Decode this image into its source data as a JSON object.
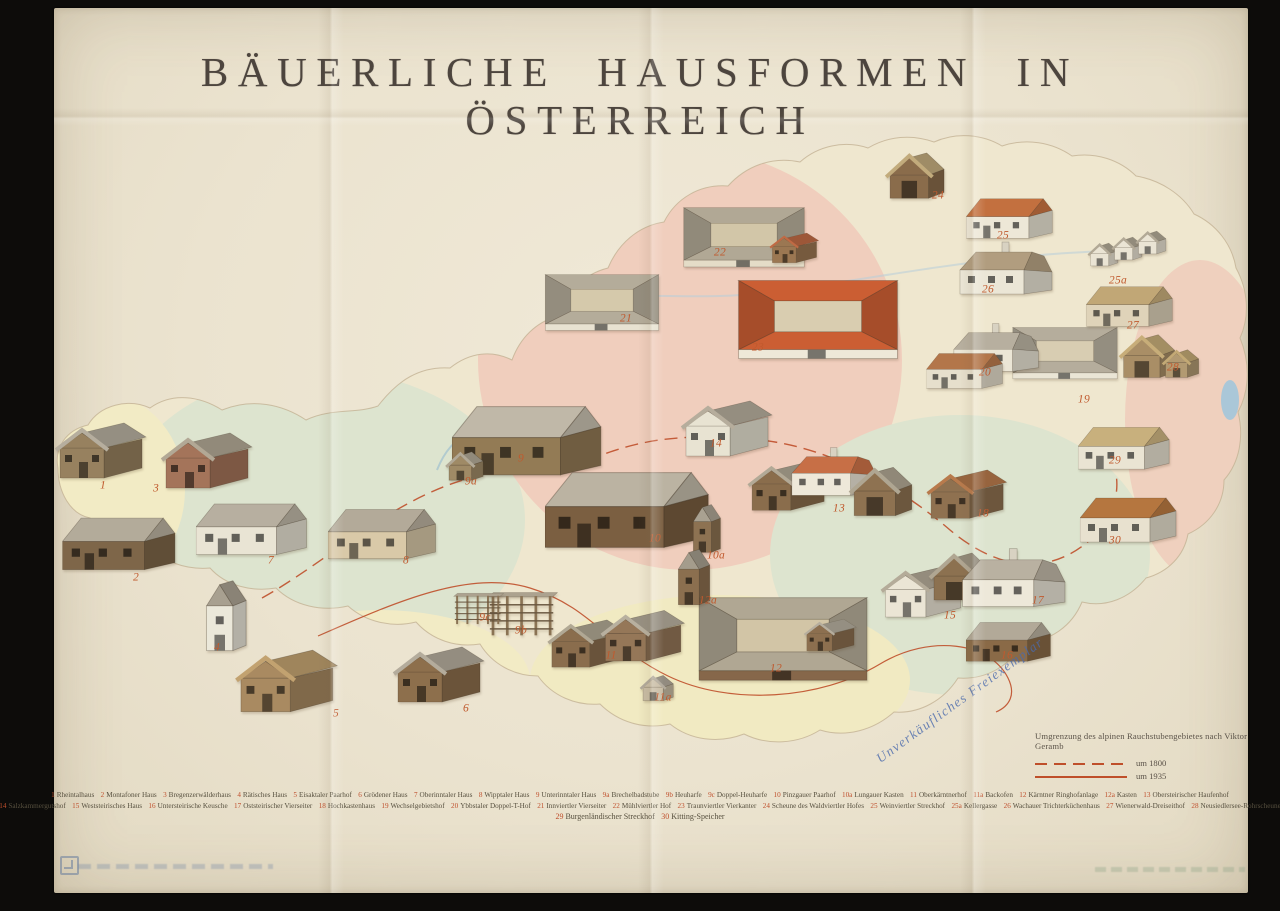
{
  "poster": {
    "title": "BÄUERLICHE HAUSFORMEN IN ÖSTERREICH",
    "stamp": "Unverkäufliches Freiexemplar",
    "colors": {
      "paper": "#ebe3cf",
      "accent_red": "#bf4f2a",
      "ink": "#57503f",
      "number_red": "#c05a2e",
      "stamp_blue": "#4a6aad",
      "map_pink": "#f0cebd",
      "map_green": "#dde4cf",
      "map_yellow": "#f1eac4",
      "lake_blue": "#a9c6d6"
    },
    "map_legend": {
      "heading": "Umgrenzung des alpinen Rauchstubengebietes nach Viktor Geramb",
      "entries": [
        {
          "style": "dashed",
          "label": "um 1800"
        },
        {
          "style": "solid",
          "label": "um 1935"
        }
      ]
    },
    "legend_lines": [
      [
        {
          "n": "1",
          "name": "Rheintalhaus"
        },
        {
          "n": "2",
          "name": "Montafoner Haus"
        },
        {
          "n": "3",
          "name": "Bregenzerwälderhaus"
        },
        {
          "n": "4",
          "name": "Rätisches Haus"
        },
        {
          "n": "5",
          "name": "Eisaktaler Paarhof"
        },
        {
          "n": "6",
          "name": "Grödener Haus"
        },
        {
          "n": "7",
          "name": "Oberinntaler Haus"
        },
        {
          "n": "8",
          "name": "Wipptaler Haus"
        },
        {
          "n": "9",
          "name": "Unterinntaler Haus"
        },
        {
          "n": "9a",
          "name": "Brechelbadstube"
        },
        {
          "n": "9b",
          "name": "Heuharfe"
        },
        {
          "n": "9c",
          "name": "Doppel-Heuharfe"
        },
        {
          "n": "10",
          "name": "Pinzgauer Paarhof"
        },
        {
          "n": "10a",
          "name": "Lungauer Kasten"
        },
        {
          "n": "11",
          "name": "Oberkärntnerhof"
        },
        {
          "n": "11a",
          "name": "Backofen"
        },
        {
          "n": "12",
          "name": "Kärntner Ringhofanlage"
        },
        {
          "n": "12a",
          "name": "Kasten"
        },
        {
          "n": "13",
          "name": "Obersteirischer Haufenhof"
        }
      ],
      [
        {
          "n": "14",
          "name": "Salzkammergutshof"
        },
        {
          "n": "15",
          "name": "Weststeirisches Haus"
        },
        {
          "n": "16",
          "name": "Untersteirische Keusche"
        },
        {
          "n": "17",
          "name": "Oststeirischer Vierseiter"
        },
        {
          "n": "18",
          "name": "Hochkastenhaus"
        },
        {
          "n": "19",
          "name": "Wechselgebietshof"
        },
        {
          "n": "20",
          "name": "Ybbstaler Doppel-T-Hof"
        },
        {
          "n": "21",
          "name": "Innviertler Vierseiter"
        },
        {
          "n": "22",
          "name": "Mühlviertler Hof"
        },
        {
          "n": "23",
          "name": "Traunviertler Vierkanter"
        },
        {
          "n": "24",
          "name": "Scheune des Waldviertler Hofes"
        },
        {
          "n": "25",
          "name": "Weinviertler Streckhof"
        },
        {
          "n": "25a",
          "name": "Kellergasse"
        },
        {
          "n": "26",
          "name": "Wachauer Trichterküchenhaus"
        },
        {
          "n": "27",
          "name": "Wienerwald-Dreiseithof"
        },
        {
          "n": "28",
          "name": "Neusiedlersee-Rohrscheune"
        }
      ],
      [
        {
          "n": "29",
          "name": "Burgenländischer Streckhof"
        },
        {
          "n": "30",
          "name": "Kitting-Speicher"
        }
      ]
    ],
    "houses": [
      {
        "n": "1",
        "lx": 103,
        "ly": 486,
        "parts": [
          {
            "t": "gable",
            "x": 52,
            "y": 414,
            "w": 100,
            "roof": "#b6ae9e",
            "wall": "#97815f"
          }
        ]
      },
      {
        "n": "2",
        "lx": 136,
        "ly": 578,
        "parts": [
          {
            "t": "long",
            "x": 62,
            "y": 504,
            "w": 118,
            "roof": "#b3ab9a",
            "wall": "#7e6649"
          }
        ]
      },
      {
        "n": "3",
        "lx": 156,
        "ly": 489,
        "parts": [
          {
            "t": "gable",
            "x": 158,
            "y": 424,
            "w": 100,
            "roof": "#b2a895",
            "wall": "#a4745a"
          }
        ]
      },
      {
        "n": "4",
        "lx": 217,
        "ly": 648,
        "parts": [
          {
            "t": "tower",
            "x": 196,
            "y": 574,
            "w": 58,
            "roof": "#a8a090",
            "wall": "#ebe8da"
          }
        ]
      },
      {
        "n": "5",
        "lx": 336,
        "ly": 714,
        "parts": [
          {
            "t": "gable",
            "x": 232,
            "y": 640,
            "w": 112,
            "roof": "#c2a270",
            "wall": "#a98a61"
          }
        ]
      },
      {
        "n": "6",
        "lx": 466,
        "ly": 709,
        "parts": [
          {
            "t": "gable",
            "x": 390,
            "y": 638,
            "w": 100,
            "roof": "#b4ac9c",
            "wall": "#8d6f4c"
          }
        ]
      },
      {
        "n": "7",
        "lx": 271,
        "ly": 561,
        "parts": [
          {
            "t": "long",
            "x": 196,
            "y": 490,
            "w": 115,
            "roof": "#b7afa0",
            "wall": "#e9e4d4"
          }
        ]
      },
      {
        "n": "8",
        "lx": 406,
        "ly": 561,
        "parts": [
          {
            "t": "long",
            "x": 328,
            "y": 496,
            "w": 112,
            "roof": "#b3aa99",
            "wall": "#d9c9a8"
          }
        ]
      },
      {
        "n": "9",
        "lx": 521,
        "ly": 459,
        "parts": [
          {
            "t": "long",
            "x": 452,
            "y": 388,
            "w": 155,
            "roof": "#c0b8a8",
            "wall": "#937b55"
          }
        ]
      },
      {
        "n": "9a",
        "lx": 471,
        "ly": 482,
        "parts": [
          {
            "t": "hut",
            "x": 443,
            "y": 448,
            "w": 48,
            "roof": "#b1a896",
            "wall": "#9f8a66"
          }
        ]
      },
      {
        "n": "9b",
        "lx": 521,
        "ly": 631,
        "parts": [
          {
            "t": "rack",
            "x": 486,
            "y": 588,
            "w": 72,
            "roof": "#aca28f",
            "wall": "#8a7354"
          }
        ]
      },
      {
        "n": "9c",
        "lx": 485,
        "ly": 618,
        "parts": [
          {
            "t": "rack",
            "x": 452,
            "y": 590,
            "w": 52,
            "roof": "#aca28f",
            "wall": "#8a7354"
          }
        ]
      },
      {
        "n": "10",
        "lx": 655,
        "ly": 539,
        "parts": [
          {
            "t": "long",
            "x": 545,
            "y": 452,
            "w": 170,
            "roof": "#bbb3a2",
            "wall": "#7b5f41"
          }
        ]
      },
      {
        "n": "10a",
        "lx": 716,
        "ly": 556,
        "parts": [
          {
            "t": "tower",
            "x": 686,
            "y": 500,
            "w": 40,
            "roof": "#a9a191",
            "wall": "#8d7252"
          }
        ]
      },
      {
        "n": "11",
        "lx": 611,
        "ly": 656,
        "parts": [
          {
            "t": "gable",
            "x": 545,
            "y": 612,
            "w": 86,
            "roof": "#b1a894",
            "wall": "#8a6d4d"
          },
          {
            "t": "gable",
            "x": 598,
            "y": 602,
            "w": 92,
            "roof": "#b8b09f",
            "wall": "#957758"
          }
        ]
      },
      {
        "n": "11a",
        "lx": 663,
        "ly": 698,
        "parts": [
          {
            "t": "hut",
            "x": 638,
            "y": 672,
            "w": 42,
            "roof": "#b2aa9b",
            "wall": "#c9bda5"
          }
        ]
      },
      {
        "n": "12",
        "lx": 776,
        "ly": 669,
        "parts": [
          {
            "t": "court",
            "x": 688,
            "y": 576,
            "w": 190,
            "roof": "#b0a793",
            "wall": "#86674a",
            "yard": "#d2c5a6"
          },
          {
            "t": "gable",
            "x": 802,
            "y": 614,
            "w": 58,
            "roof": "#b6ae9e",
            "wall": "#8c6f4f"
          }
        ]
      },
      {
        "n": "12a",
        "lx": 708,
        "ly": 601,
        "parts": [
          {
            "t": "tower",
            "x": 670,
            "y": 544,
            "w": 46,
            "roof": "#a49c8c",
            "wall": "#8b6f4f"
          }
        ]
      },
      {
        "n": "13",
        "lx": 839,
        "ly": 509,
        "parts": [
          {
            "t": "gable",
            "x": 745,
            "y": 454,
            "w": 88,
            "roof": "#b2a996",
            "wall": "#8a6d4c"
          },
          {
            "t": "hip",
            "x": 790,
            "y": 442,
            "w": 92,
            "roof": "#c76f46",
            "wall": "#eee8d9"
          },
          {
            "t": "barn",
            "x": 848,
            "y": 464,
            "w": 72,
            "roof": "#afa692",
            "wall": "#8e7251"
          }
        ]
      },
      {
        "n": "14",
        "lx": 716,
        "ly": 444,
        "parts": [
          {
            "t": "gable",
            "x": 678,
            "y": 392,
            "w": 100,
            "roof": "#b6ad9c",
            "wall": "#e8e3d2"
          }
        ]
      },
      {
        "n": "15",
        "lx": 950,
        "ly": 616,
        "parts": [
          {
            "t": "gable",
            "x": 878,
            "y": 558,
            "w": 92,
            "roof": "#b4ab99",
            "wall": "#ebe5d5"
          },
          {
            "t": "barn",
            "x": 928,
            "y": 550,
            "w": 70,
            "roof": "#b0a692",
            "wall": "#8c7150"
          }
        ]
      },
      {
        "n": "16",
        "lx": 1007,
        "ly": 656,
        "parts": [
          {
            "t": "long",
            "x": 966,
            "y": 612,
            "w": 88,
            "roof": "#b2a998",
            "wall": "#8a6a47"
          }
        ]
      },
      {
        "n": "17",
        "lx": 1038,
        "ly": 601,
        "parts": [
          {
            "t": "hip",
            "x": 960,
            "y": 542,
            "w": 112,
            "roof": "#b9b1a1",
            "wall": "#ede8d9"
          }
        ]
      },
      {
        "n": "18",
        "lx": 983,
        "ly": 514,
        "parts": [
          {
            "t": "gable",
            "x": 924,
            "y": 462,
            "w": 88,
            "roof": "#b87a4c",
            "wall": "#8f7150"
          }
        ]
      },
      {
        "n": "19",
        "lx": 1084,
        "ly": 400,
        "parts": [
          {
            "t": "court",
            "x": 1006,
            "y": 314,
            "w": 118,
            "roof": "#b5ad9c",
            "wall": "#eae5d5",
            "yard": "#d8cdb2"
          }
        ]
      },
      {
        "n": "20",
        "lx": 985,
        "ly": 373,
        "parts": [
          {
            "t": "hip",
            "x": 952,
            "y": 318,
            "w": 92,
            "roof": "#b7af9f",
            "wall": "#ebe6d6"
          },
          {
            "t": "long",
            "x": 926,
            "y": 344,
            "w": 80,
            "roof": "#b3764a",
            "wall": "#e6dfcc"
          }
        ]
      },
      {
        "n": "21",
        "lx": 626,
        "ly": 319,
        "parts": [
          {
            "t": "court",
            "x": 538,
            "y": 260,
            "w": 128,
            "roof": "#b4ac9a",
            "wall": "#e8e2d1",
            "yard": "#d5c9ab"
          }
        ]
      },
      {
        "n": "22",
        "lx": 720,
        "ly": 253,
        "parts": [
          {
            "t": "court",
            "x": 676,
            "y": 192,
            "w": 136,
            "roof": "#b1a895",
            "wall": "#e4dcc7",
            "yard": "#d2c6a8"
          },
          {
            "t": "gable",
            "x": 768,
            "y": 228,
            "w": 54,
            "roof": "#c06a44",
            "wall": "#9b7752"
          }
        ]
      },
      {
        "n": "23",
        "lx": 758,
        "ly": 348,
        "parts": [
          {
            "t": "court",
            "x": 728,
            "y": 260,
            "w": 180,
            "roof": "#cb5e33",
            "wall": "#eee8d8",
            "yard": "#d9cdb0"
          }
        ]
      },
      {
        "n": "24",
        "lx": 938,
        "ly": 196,
        "parts": [
          {
            "t": "barn",
            "x": 884,
            "y": 150,
            "w": 68,
            "roof": "#c2ab7c",
            "wall": "#8a6c4b"
          }
        ]
      },
      {
        "n": "25",
        "lx": 1003,
        "ly": 236,
        "parts": [
          {
            "t": "long",
            "x": 966,
            "y": 188,
            "w": 90,
            "roof": "#c3703f",
            "wall": "#ede7d7"
          }
        ]
      },
      {
        "n": "25a",
        "lx": 1118,
        "ly": 281,
        "parts": [
          {
            "t": "hut",
            "x": 1086,
            "y": 240,
            "w": 38,
            "roof": "#b2a996",
            "wall": "#eae4d4"
          },
          {
            "t": "hut",
            "x": 1110,
            "y": 234,
            "w": 38,
            "roof": "#b2a996",
            "wall": "#eae4d4"
          },
          {
            "t": "hut",
            "x": 1134,
            "y": 228,
            "w": 38,
            "roof": "#b2a996",
            "wall": "#eae4d4"
          }
        ]
      },
      {
        "n": "26",
        "lx": 988,
        "ly": 290,
        "parts": [
          {
            "t": "hip",
            "x": 958,
            "y": 236,
            "w": 100,
            "roof": "#b19d7f",
            "wall": "#ebe6d6"
          }
        ]
      },
      {
        "n": "27",
        "lx": 1133,
        "ly": 326,
        "parts": [
          {
            "t": "long",
            "x": 1086,
            "y": 276,
            "w": 90,
            "roof": "#c1a776",
            "wall": "#dfd3b9"
          }
        ]
      },
      {
        "n": "28",
        "lx": 1173,
        "ly": 368,
        "parts": [
          {
            "t": "barn",
            "x": 1118,
            "y": 332,
            "w": 64,
            "roof": "#c7ad79",
            "wall": "#a98e66"
          },
          {
            "t": "hut",
            "x": 1160,
            "y": 346,
            "w": 46,
            "roof": "#c3a975",
            "wall": "#b29a72"
          }
        ]
      },
      {
        "n": "29",
        "lx": 1115,
        "ly": 461,
        "parts": [
          {
            "t": "long",
            "x": 1078,
            "y": 416,
            "w": 95,
            "roof": "#c8b07d",
            "wall": "#eae4d3"
          }
        ]
      },
      {
        "n": "30",
        "lx": 1115,
        "ly": 541,
        "parts": [
          {
            "t": "long",
            "x": 1080,
            "y": 486,
            "w": 100,
            "roof": "#b5763f",
            "wall": "#e8e1cf"
          }
        ]
      }
    ]
  }
}
